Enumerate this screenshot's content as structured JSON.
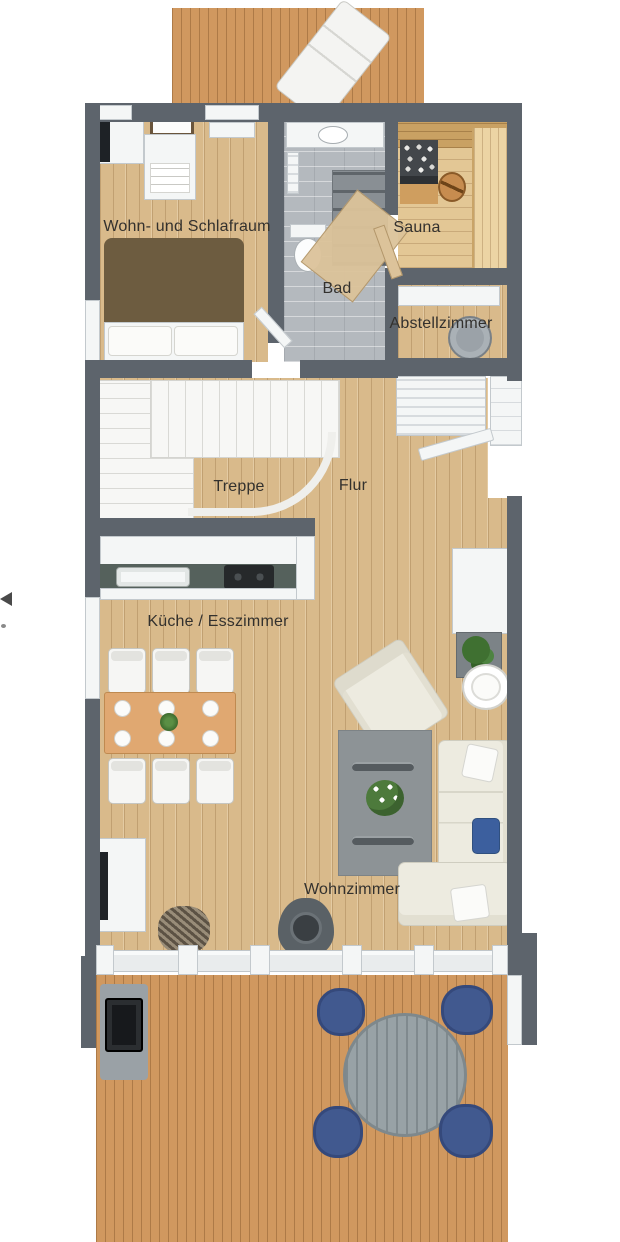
{
  "plan": {
    "type": "3D top-down floor plan rendering of a holiday house level",
    "background": "#ffffff"
  },
  "rooms": {
    "bedroom": {
      "label": "Wohn- und Schlafraum"
    },
    "sauna": {
      "label": "Sauna"
    },
    "bathroom": {
      "label": "Bad"
    },
    "storage_room": {
      "label": "Abstellzimmer"
    },
    "stairs": {
      "label": "Treppe"
    },
    "hallway": {
      "label": "Flur"
    },
    "kitchen_dining": {
      "label": "Küche / Esszimmer"
    },
    "living_room": {
      "label": "Wohnzimmer"
    }
  },
  "colors": {
    "wall": "#5d646c",
    "pine_floor": "#d9ba8b",
    "terrace_deck": "#d0985f",
    "bathroom_tile": "#b4b9be",
    "rug_gray": "#8d9396",
    "sofa_cream": "#edebe0",
    "bed_blanket_brown": "#6d5c40",
    "dining_table_wood": "#e0a871",
    "outdoor_chair_blue": "#41598f",
    "outdoor_table_gray": "#98a2a6",
    "kitchen_countertop": "#55615c",
    "stove_black": "#26292b"
  },
  "furniture": {
    "bedroom": [
      "wardrobe with TV",
      "mirror",
      "dresser",
      "double bed"
    ],
    "bathroom": [
      "vanity with sink",
      "towel radiator",
      "shower",
      "toilet",
      "open wooden door"
    ],
    "sauna": [
      "sauna heater with stones",
      "wooden bucket",
      "benches"
    ],
    "storage_room": [
      "wall shelf",
      "water boiler"
    ],
    "kitchen_dining": [
      "kitchen counter",
      "sink",
      "cooktop",
      "dining table",
      "6 chairs",
      "plates",
      "plant centerpiece"
    ],
    "living_room": [
      "armchair",
      "gray rug",
      "glass coffee table",
      "flowers",
      "corner sofa",
      "blue cushion",
      "side table",
      "planter",
      "tall cabinet",
      "sideboard with TV",
      "wood stove",
      "firewood pile"
    ],
    "hallway": [
      "slatted bench",
      "entrance door",
      "entry landing"
    ],
    "top_terrace": [
      "sun lounger"
    ],
    "bottom_terrace": [
      "round table",
      "4 blue chairs",
      "grill"
    ]
  }
}
